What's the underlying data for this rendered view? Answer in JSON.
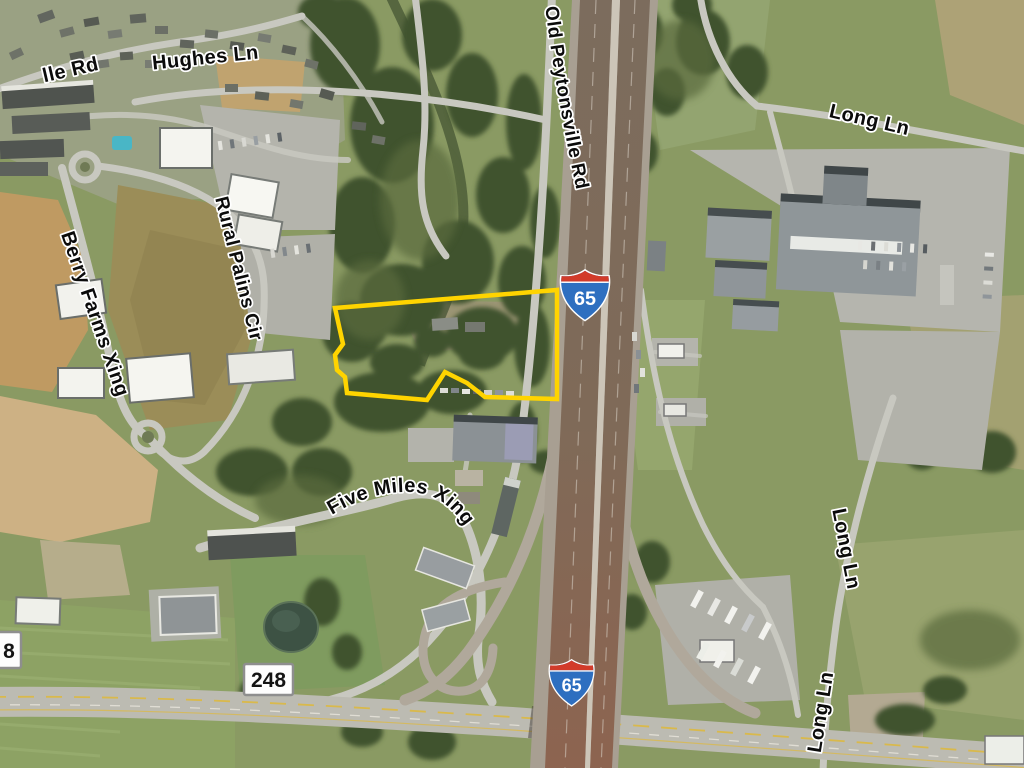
{
  "map": {
    "view": "aerial-satellite",
    "road_labels": {
      "ille_rd": "lle Rd",
      "hughes_ln": "Hughes Ln",
      "old_peytonsville_rd": "Old Peytonsville Rd",
      "long_ln_top": "Long Ln",
      "berry_farms_xing": "Berry Farms Xing",
      "rural_palins_cir": "Rural Palins Cir",
      "five_miles_xing": "Five Miles Xing",
      "long_ln_mid": "Long Ln",
      "long_ln_bottom": "Long Ln"
    },
    "route_shields": {
      "interstate_north": {
        "system": "Interstate",
        "number": "65"
      },
      "interstate_south": {
        "system": "Interstate",
        "number": "65"
      },
      "state_248": {
        "number": "248"
      },
      "state_partial": {
        "number": "8"
      }
    },
    "parcel": {
      "outline_color": "#FFD400",
      "points": "335,308 557,290 557,399 485,397 467,383 445,372 427,400 347,393 345,377 337,370 335,355 343,344"
    },
    "colors": {
      "parcel_outline": "#FFD400",
      "interstate_blue": "#2E6FC0",
      "interstate_red": "#D23B2A",
      "shield_text": "#FFFFFF",
      "label_fill": "#0B0B0B",
      "label_halo": "#FFFFFF"
    }
  }
}
